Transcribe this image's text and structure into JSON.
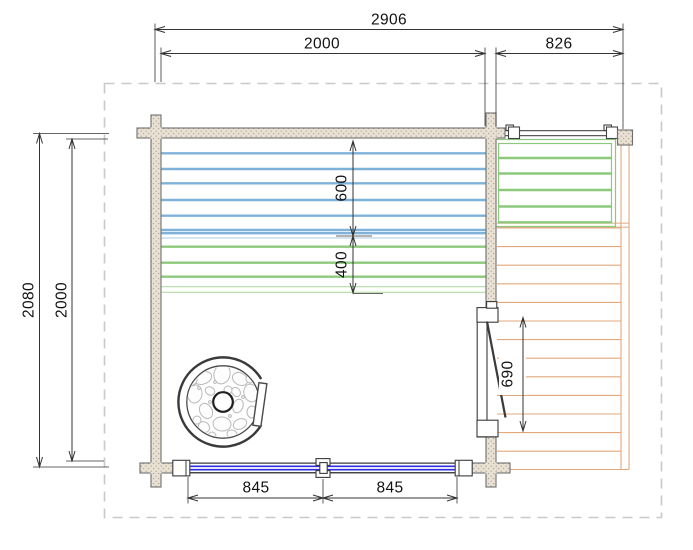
{
  "dimensions": {
    "overall_width": "2906",
    "room_width": "2000",
    "terrace_width": "826",
    "overall_depth": "2080",
    "room_depth": "2000",
    "bench_upper_depth": "600",
    "bench_lower_depth": "400",
    "door_opening": "690",
    "window_segment_left": "845",
    "window_segment_right": "845"
  },
  "colors": {
    "wall-fill": "#e9e1d3",
    "wall-dot": "#b4aa99",
    "wall-stroke": "#6e6e6e",
    "bench-blue": "#7fb2d9",
    "bench-blue-thin": "#a9cae6",
    "bench-green": "#8cc97c",
    "bench-green-thin": "#b2dba6",
    "deck-orange": "#e2a87c",
    "deck-tan": "#dfb592",
    "window-blue": "#2f2fe0",
    "line-dark": "#3a3a3a",
    "dim-line": "#333333",
    "dim-text": "#111111",
    "overhang-dash": "#c9c9c9",
    "stone-gray": "#b9b9b9"
  }
}
